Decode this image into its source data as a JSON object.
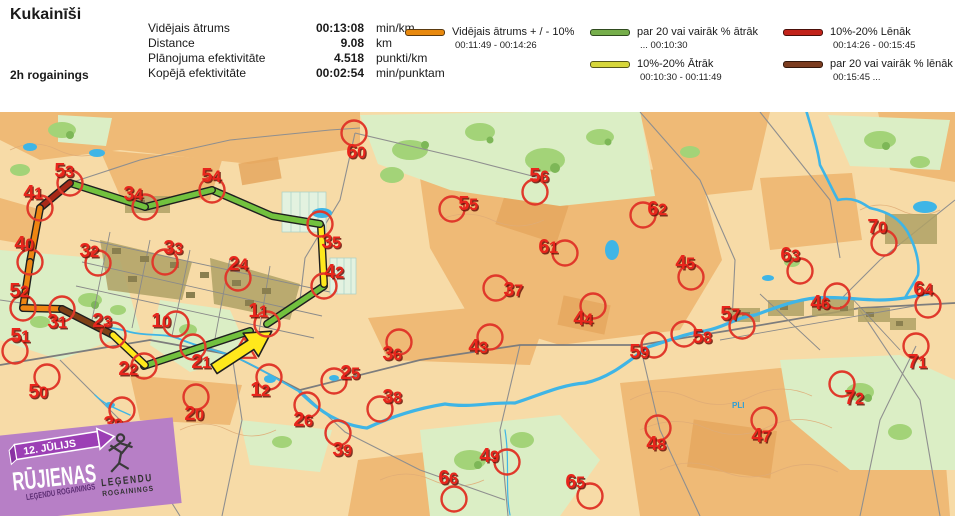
{
  "header": {
    "title": "Kukainīši",
    "event": "2h rogainings",
    "points": "Punkti: 41",
    "time": "01:59:07",
    "stats": [
      {
        "label": "Vidējais ātrums",
        "value": "00:13:08",
        "unit": "min/km"
      },
      {
        "label": "Distance",
        "value": "9.08",
        "unit": "km"
      },
      {
        "label": "Plānojuma efektivitāte",
        "value": "4.518",
        "unit": "punkti/km"
      },
      {
        "label": "Kopējā efektivitāte",
        "value": "00:02:54",
        "unit": "min/punktam"
      }
    ],
    "legend": [
      {
        "col": 1,
        "color": "#E8890E",
        "outline": "#5a3a10",
        "label": "Vidējais ātrums + / - 10%",
        "range": "00:11:49   -   00:14:26"
      },
      {
        "col": 2,
        "color": "#76AE4B",
        "outline": "#2f4a1f",
        "label": "par 20 vai vairāk % ātrāk",
        "range": "...      00:10:30"
      },
      {
        "col": 2,
        "color": "#D6D63A",
        "outline": "#55551a",
        "label": "10%-20% Ātrāk",
        "range": "00:10:30   -   00:11:49"
      },
      {
        "col": 3,
        "color": "#C2231A",
        "outline": "#4a0f0a",
        "label": "10%-20% Lēnāk",
        "range": "00:14:26   -  00:15:45"
      },
      {
        "col": 3,
        "color": "#7C3D20",
        "outline": "#33180c",
        "label": "par 20 vai vairāk % lēnāk",
        "range": "00:15:45    ..."
      }
    ]
  },
  "map": {
    "colors": {
      "green": "#72C13E",
      "yellow": "#FFE81C",
      "orange": "#EE8512",
      "brown": "#7E4016",
      "darkred": "#A82A18",
      "circle": "#E0392B",
      "label": "#E8251C",
      "label_shadow": "#6b140b",
      "outline": "#1f1f1f"
    },
    "route": [
      {
        "color": "green",
        "pts": [
          [
            144,
            366
          ],
          [
            250,
            331
          ]
        ]
      },
      {
        "color": "green",
        "pts": [
          [
            267,
            324
          ],
          [
            324,
            286
          ]
        ]
      },
      {
        "color": "yellow",
        "pts": [
          [
            324,
            284
          ],
          [
            321,
            226
          ]
        ]
      },
      {
        "color": "green",
        "pts": [
          [
            320,
            224
          ],
          [
            272,
            216
          ],
          [
            212,
            190
          ]
        ]
      },
      {
        "color": "green",
        "pts": [
          [
            212,
            190
          ],
          [
            145,
            207
          ]
        ]
      },
      {
        "color": "green",
        "pts": [
          [
            145,
            207
          ],
          [
            70,
            183
          ]
        ]
      },
      {
        "color": "darkred",
        "pts": [
          [
            70,
            183
          ],
          [
            40,
            208
          ]
        ]
      },
      {
        "color": "orange",
        "pts": [
          [
            40,
            208
          ],
          [
            30,
            262
          ]
        ]
      },
      {
        "color": "orange",
        "pts": [
          [
            30,
            262
          ],
          [
            23,
            308
          ]
        ]
      },
      {
        "color": "orange",
        "pts": [
          [
            23,
            308
          ],
          [
            62,
            309
          ]
        ]
      },
      {
        "color": "brown",
        "pts": [
          [
            62,
            309
          ],
          [
            113,
            335
          ]
        ]
      },
      {
        "color": "yellow",
        "pts": [
          [
            113,
            335
          ],
          [
            145,
            365
          ]
        ]
      }
    ],
    "arrow": {
      "x": 214,
      "y": 369,
      "angle": -33.2
    },
    "start_triangle": {
      "x": 244,
      "y": 351
    },
    "controls": [
      {
        "n": "53",
        "cx": 70,
        "cy": 183,
        "lx": 64,
        "ly": 177
      },
      {
        "n": "41",
        "cx": 40,
        "cy": 208,
        "lx": 33,
        "ly": 199
      },
      {
        "n": "34",
        "cx": 145,
        "cy": 207,
        "lx": 133,
        "ly": 200
      },
      {
        "n": "54",
        "cx": 212,
        "cy": 190,
        "lx": 211,
        "ly": 182
      },
      {
        "n": "40",
        "cx": 30,
        "cy": 262,
        "lx": 24,
        "ly": 250
      },
      {
        "n": "32",
        "cx": 98,
        "cy": 263,
        "lx": 89,
        "ly": 257
      },
      {
        "n": "33",
        "cx": 165,
        "cy": 262,
        "lx": 173,
        "ly": 254
      },
      {
        "n": "24",
        "cx": 238,
        "cy": 278,
        "lx": 238,
        "ly": 270
      },
      {
        "n": "35",
        "cx": 320,
        "cy": 224,
        "lx": 331,
        "ly": 248
      },
      {
        "n": "42",
        "cx": 324,
        "cy": 286,
        "lx": 334,
        "ly": 278
      },
      {
        "n": "11",
        "cx": 267,
        "cy": 324,
        "lx": 258,
        "ly": 317
      },
      {
        "n": "60",
        "cx": 354,
        "cy": 133,
        "lx": 356,
        "ly": 158
      },
      {
        "n": "52",
        "cx": 23,
        "cy": 308,
        "lx": 19,
        "ly": 297
      },
      {
        "n": "31",
        "cx": 62,
        "cy": 309,
        "lx": 57,
        "ly": 328
      },
      {
        "n": "23",
        "cx": 113,
        "cy": 335,
        "lx": 102,
        "ly": 327
      },
      {
        "n": "51",
        "cx": 15,
        "cy": 351,
        "lx": 20,
        "ly": 342
      },
      {
        "n": "22",
        "cx": 144,
        "cy": 366,
        "lx": 128,
        "ly": 375
      },
      {
        "n": "10",
        "cx": 176,
        "cy": 324,
        "lx": 161,
        "ly": 327
      },
      {
        "n": "21",
        "cx": 193,
        "cy": 347,
        "lx": 201,
        "ly": 368
      },
      {
        "n": "50",
        "cx": 47,
        "cy": 377,
        "lx": 38,
        "ly": 398
      },
      {
        "n": "30",
        "cx": 122,
        "cy": 410,
        "lx": 113,
        "ly": 430
      },
      {
        "n": "20",
        "cx": 196,
        "cy": 397,
        "lx": 194,
        "ly": 420
      },
      {
        "n": "12",
        "cx": 269,
        "cy": 377,
        "lx": 260,
        "ly": 396
      },
      {
        "n": "26",
        "cx": 307,
        "cy": 405,
        "lx": 303,
        "ly": 426
      },
      {
        "n": "55",
        "cx": 452,
        "cy": 209,
        "lx": 468,
        "ly": 210
      },
      {
        "n": "56",
        "cx": 535,
        "cy": 192,
        "lx": 539,
        "ly": 182
      },
      {
        "n": "61",
        "cx": 565,
        "cy": 253,
        "lx": 548,
        "ly": 253
      },
      {
        "n": "37",
        "cx": 496,
        "cy": 288,
        "lx": 513,
        "ly": 296
      },
      {
        "n": "62",
        "cx": 643,
        "cy": 215,
        "lx": 657,
        "ly": 215
      },
      {
        "n": "45",
        "cx": 691,
        "cy": 277,
        "lx": 685,
        "ly": 269
      },
      {
        "n": "63",
        "cx": 800,
        "cy": 271,
        "lx": 790,
        "ly": 261
      },
      {
        "n": "70",
        "cx": 884,
        "cy": 243,
        "lx": 877,
        "ly": 233
      },
      {
        "n": "64",
        "cx": 928,
        "cy": 305,
        "lx": 923,
        "ly": 295
      },
      {
        "n": "46",
        "cx": 837,
        "cy": 296,
        "lx": 820,
        "ly": 309
      },
      {
        "n": "44",
        "cx": 593,
        "cy": 306,
        "lx": 583,
        "ly": 325
      },
      {
        "n": "43",
        "cx": 490,
        "cy": 337,
        "lx": 478,
        "ly": 353
      },
      {
        "n": "36",
        "cx": 399,
        "cy": 342,
        "lx": 392,
        "ly": 360
      },
      {
        "n": "25",
        "cx": 334,
        "cy": 381,
        "lx": 350,
        "ly": 379
      },
      {
        "n": "38",
        "cx": 380,
        "cy": 409,
        "lx": 392,
        "ly": 403
      },
      {
        "n": "39",
        "cx": 338,
        "cy": 433,
        "lx": 342,
        "ly": 456
      },
      {
        "n": "49",
        "cx": 507,
        "cy": 462,
        "lx": 489,
        "ly": 462
      },
      {
        "n": "66",
        "cx": 454,
        "cy": 499,
        "lx": 448,
        "ly": 484
      },
      {
        "n": "65",
        "cx": 590,
        "cy": 496,
        "lx": 575,
        "ly": 488
      },
      {
        "n": "57",
        "cx": 742,
        "cy": 326,
        "lx": 730,
        "ly": 320
      },
      {
        "n": "58",
        "cx": 684,
        "cy": 334,
        "lx": 702,
        "ly": 343
      },
      {
        "n": "59",
        "cx": 654,
        "cy": 345,
        "lx": 639,
        "ly": 358
      },
      {
        "n": "71",
        "cx": 916,
        "cy": 346,
        "lx": 917,
        "ly": 368
      },
      {
        "n": "72",
        "cx": 842,
        "cy": 384,
        "lx": 854,
        "ly": 404
      },
      {
        "n": "48",
        "cx": 658,
        "cy": 428,
        "lx": 656,
        "ly": 450
      },
      {
        "n": "47",
        "cx": 764,
        "cy": 420,
        "lx": 761,
        "ly": 442
      }
    ],
    "water_label": "PLI"
  },
  "logo": {
    "date": "12. JŪLIJS",
    "title": "RŪJIENAS",
    "subtitle": "LEĢENDU ROGAININGS",
    "badge_line1": "LEĢENDU",
    "badge_line2": "ROGAININGS"
  }
}
